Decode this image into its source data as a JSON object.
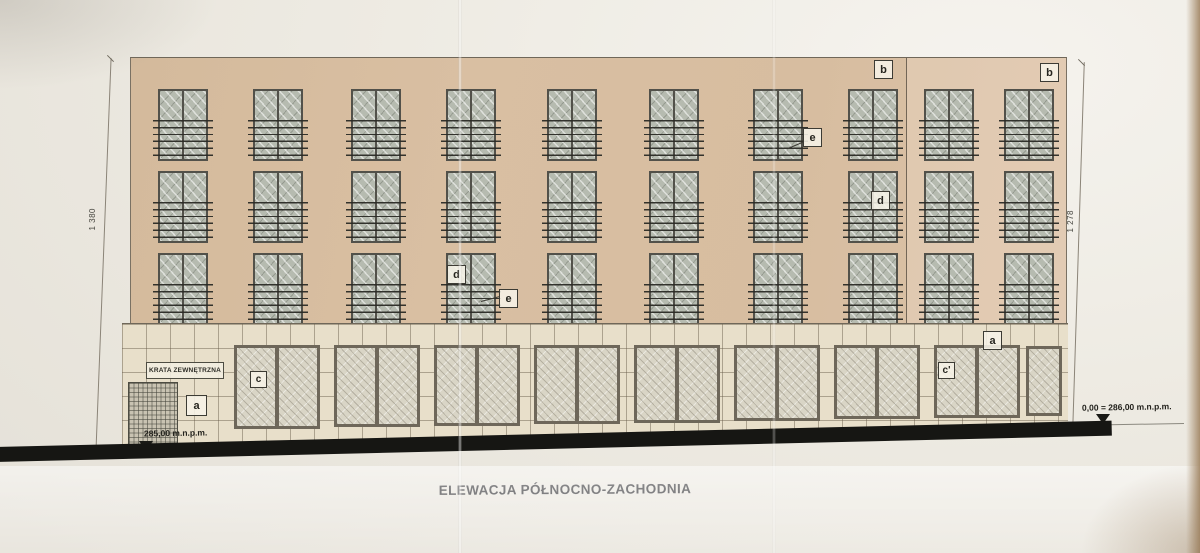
{
  "drawing": {
    "title": "ELEWACJA PÓŁNOCNO-ZACHODNIA",
    "dimensions": {
      "left_height": "1 380",
      "right_height": "1 278"
    },
    "levels": {
      "left": "285,00 m.n.p.m.",
      "right": "0,00 = 286,00 m.n.p.m."
    },
    "annotations": {
      "a": "a",
      "b": "b",
      "c": "c",
      "c_prime": "c'",
      "d": "d",
      "e": "e",
      "krata": "KRATA ZEWNĘTRZNA"
    }
  }
}
